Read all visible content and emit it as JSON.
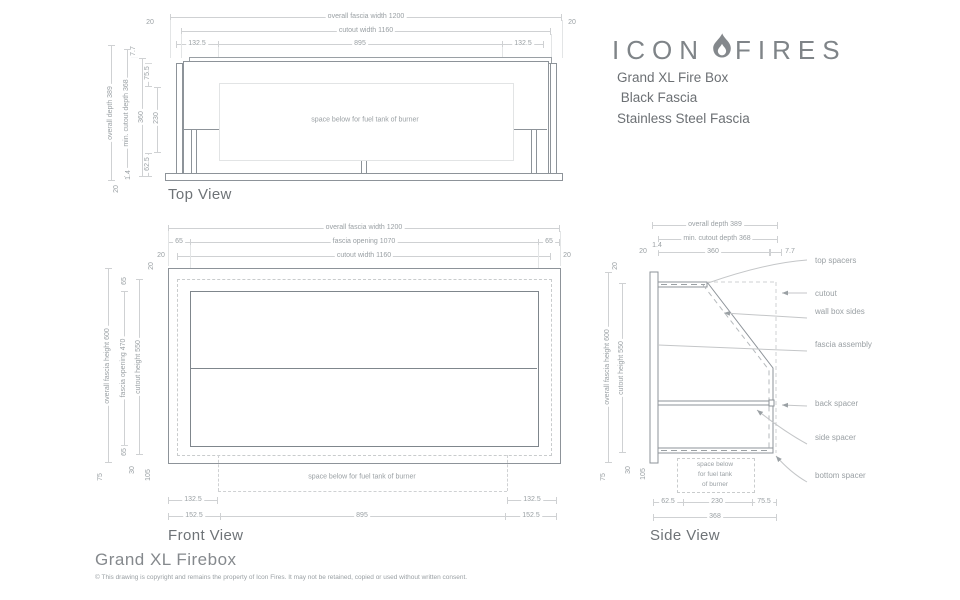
{
  "header": {
    "logo_left": "ICON",
    "logo_right": "FIRES",
    "product_lines": [
      "Grand XL Fire Box",
      " Black Fascia",
      "Stainless Steel Fascia"
    ]
  },
  "top_view": {
    "title": "Top View",
    "note": "space below for fuel tank of burner",
    "dims": {
      "overall_width": "overall fascia width 1200",
      "cutout_width": "cutout width 1160",
      "m20l": "20",
      "m20r": "20",
      "w1325l": "132.5",
      "w895": "895",
      "w1325r": "132.5",
      "overall_depth": "overall depth 389",
      "min_cutout_depth": "min. cutout depth 368",
      "d77": "7.7",
      "d755": "75.5",
      "d360": "360",
      "d230": "230",
      "d625": "62.5",
      "d14": "1.4",
      "d20": "20"
    }
  },
  "front_view": {
    "title": "Front View",
    "note": "space below for fuel tank of burner",
    "dims": {
      "overall_width": "overall fascia width 1200",
      "opening_width": "fascia opening 1070",
      "cutout_width": "cutout width 1160",
      "m65l": "65",
      "m65r": "65",
      "m20l": "20",
      "m20r": "20",
      "overall_height": "overall fascia height 600",
      "opening_height": "fascia opening 470",
      "cutout_height": "cutout height 550",
      "t20": "20",
      "t65": "65",
      "b65": "65",
      "b30": "30",
      "b105": "105",
      "b75": "75",
      "w1325l": "132.5",
      "w1325r": "132.5",
      "w1525l": "152.5",
      "w895": "895",
      "w1525r": "152.5"
    }
  },
  "side_view": {
    "title": "Side View",
    "note_lines": [
      "space below",
      "for fuel tank",
      "of burner"
    ],
    "dims": {
      "overall_depth": "overall depth 389",
      "min_cutout_depth": "min. cutout depth 368",
      "t20": "20",
      "t14": "1.4",
      "t360": "360",
      "t77": "7.7",
      "overall_height": "overall fascia height 600",
      "cutout_height": "cutout height 550",
      "l20": "20",
      "b75": "75",
      "b30": "30",
      "b105": "105",
      "w625": "62.5",
      "w230": "230",
      "w755": "75.5",
      "w368": "368"
    },
    "callouts": [
      "top spacers",
      "cutout",
      "wall box sides",
      "fascia assembly",
      "back spacer",
      "side spacer",
      "bottom spacer"
    ]
  },
  "footer": {
    "title": "Grand XL Firebox",
    "copyright": "© This drawing is copyright and remains the property of Icon Fires. It may not be retained, copied or used without written consent."
  }
}
